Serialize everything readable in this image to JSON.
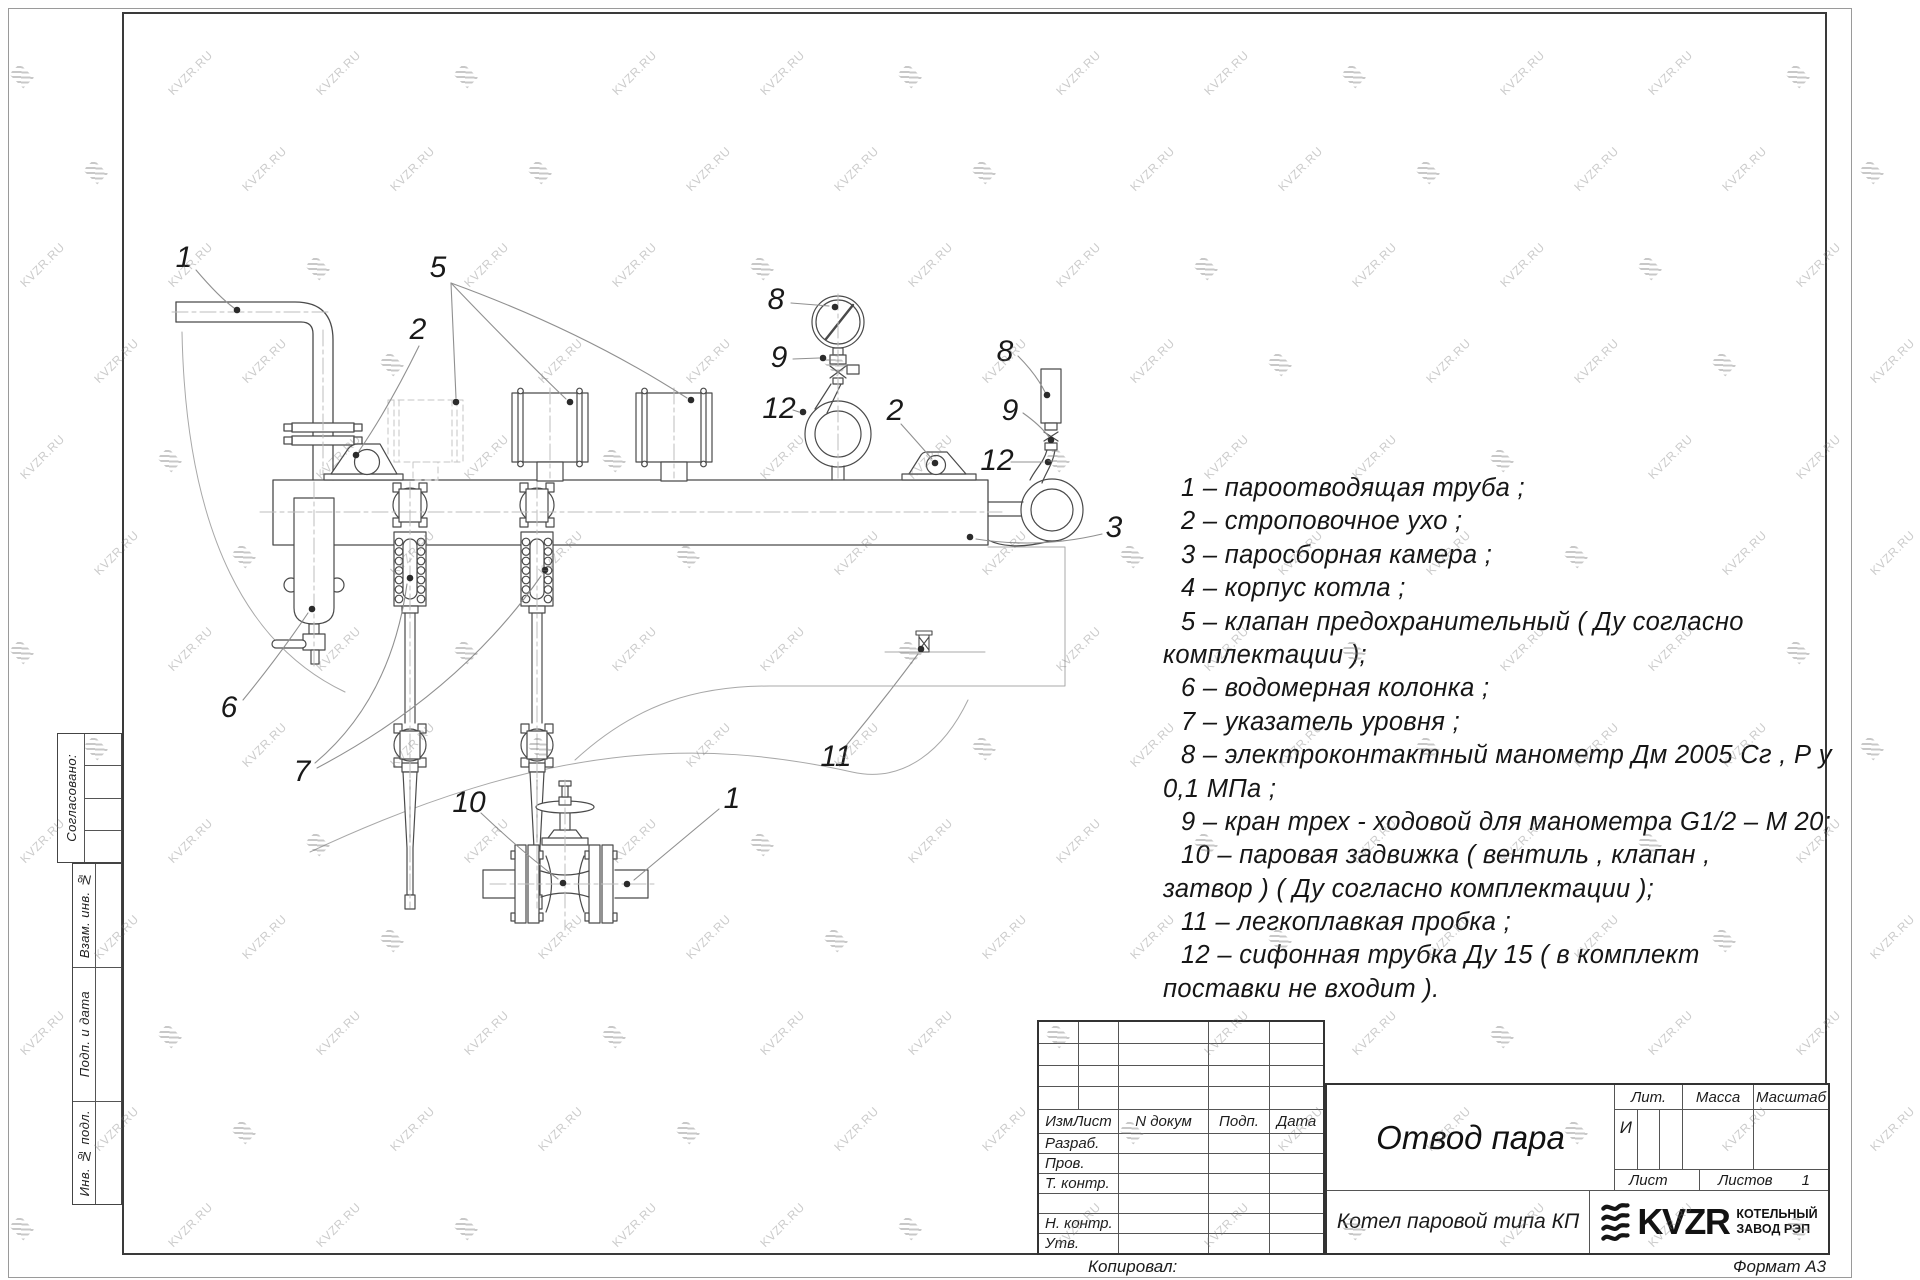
{
  "watermark": {
    "text": "KVZR.RU"
  },
  "margin": {
    "approved": "Согласовано:",
    "labels": [
      "Взам. инв. №",
      "Подп. и дата",
      "Инв. № подл."
    ]
  },
  "legend": {
    "lines": [
      {
        "t": "1 –  пароотводящая труба ;",
        "cont": false
      },
      {
        "t": "2 –  строповочное ухо ;",
        "cont": false
      },
      {
        "t": "3 –  паросборная камера ;",
        "cont": false
      },
      {
        "t": "4 –  корпус котла ;",
        "cont": false
      },
      {
        "t": "5 –  клапан предохранительный ( Ду согласно",
        "cont": false
      },
      {
        "t": "комплектации );",
        "cont": true
      },
      {
        "t": "6 –  водомерная колонка ;",
        "cont": false
      },
      {
        "t": "7 – указатель уровня ;",
        "cont": false
      },
      {
        "t": "8 – электроконтактный манометр Дм 2005 Сг , Р у",
        "cont": false
      },
      {
        "t": "0,1  МПа ;",
        "cont": true
      },
      {
        "t": "9 –  кран трех - ходовой для манометра  G1/2 – М 20;",
        "cont": false
      },
      {
        "t": "10 –  паровая задвижка  ( вентиль , клапан ,",
        "cont": false
      },
      {
        "t": "затвор ) ( Ду согласно комплектации );",
        "cont": true
      },
      {
        "t": "11 –  легкоплавкая пробка ;",
        "cont": false
      },
      {
        "t": "12 –  сифонная трубка  Ду 15 ( в комплект",
        "cont": false
      },
      {
        "t": "поставки не входит ).",
        "cont": true
      }
    ]
  },
  "drawing": {
    "callouts": [
      {
        "label": "1",
        "x": 184,
        "y": 258
      },
      {
        "label": "5",
        "x": 438,
        "y": 268
      },
      {
        "label": "2",
        "x": 418,
        "y": 330
      },
      {
        "label": "8",
        "x": 776,
        "y": 300
      },
      {
        "label": "9",
        "x": 779,
        "y": 358
      },
      {
        "label": "12",
        "x": 779,
        "y": 409
      },
      {
        "label": "2",
        "x": 895,
        "y": 411
      },
      {
        "label": "8",
        "x": 1005,
        "y": 352
      },
      {
        "label": "9",
        "x": 1010,
        "y": 411
      },
      {
        "label": "12",
        "x": 997,
        "y": 461
      },
      {
        "label": "3",
        "x": 1114,
        "y": 528
      },
      {
        "label": "6",
        "x": 229,
        "y": 708
      },
      {
        "label": "7",
        "x": 302,
        "y": 772
      },
      {
        "label": "10",
        "x": 469,
        "y": 803
      },
      {
        "label": "1",
        "x": 732,
        "y": 799
      },
      {
        "label": "11",
        "x": 836,
        "y": 757
      }
    ]
  },
  "titleblock": {
    "cols": [
      "ИзмЛист",
      "N докум",
      "Подп.",
      "Дата"
    ],
    "rows": [
      "Разраб.",
      "Пров.",
      "Т. контр.",
      "",
      "Н. контр.",
      "Утв."
    ],
    "title": "Отвод пара",
    "lit_label": "Лит.",
    "mass_label": "Масса",
    "scale_label": "Масштаб",
    "lit_value": "И",
    "sheet_label": "Лист",
    "sheets_label": "Листов",
    "sheets_value": "1",
    "product": "Котел паровой типа КП",
    "brand": "KVZR",
    "brand_sub1": "КОТЕЛЬНЫЙ",
    "brand_sub2": "ЗАВОД РЭП",
    "copied": "Копировал:",
    "format": "Формат А3"
  }
}
